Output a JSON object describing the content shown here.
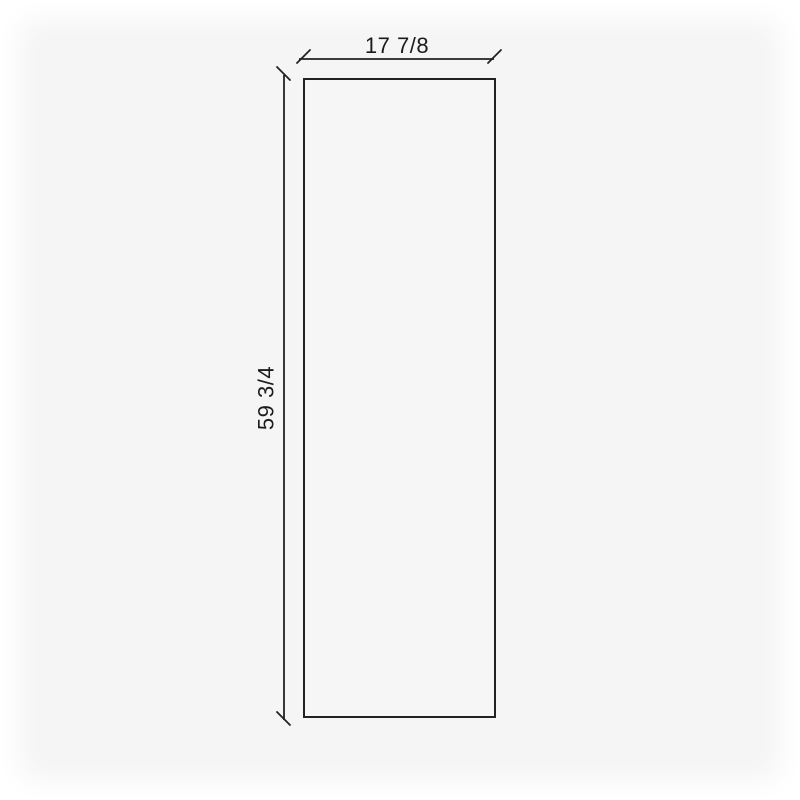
{
  "page": {
    "background_color": "#ffffff",
    "canvas_color": "#f5f5f5"
  },
  "diagram": {
    "type": "dimension-diagram",
    "shape": "rectangle",
    "line_color": "#222222",
    "text_color": "#1c1c1c",
    "panel_fill_color": "#f6f6f6",
    "dimensions": {
      "width": {
        "label": "17 7/8"
      },
      "height": {
        "label": "59 3/4"
      }
    }
  }
}
